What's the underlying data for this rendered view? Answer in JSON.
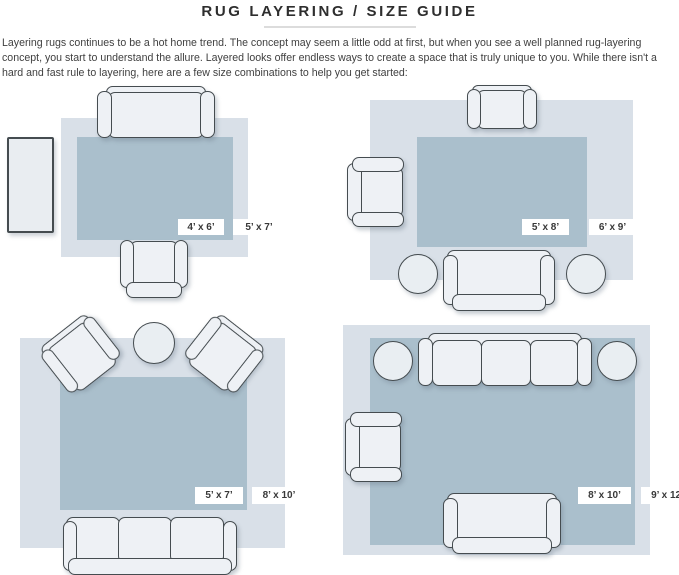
{
  "header": {
    "title": "RUG LAYERING / SIZE GUIDE",
    "intro": "Layering rugs continues to be a hot home trend. The concept may seem a little odd at first, but when you see a well planned rug-layering concept, you start to understand the allure. Layered looks offer endless ways to create a space that is truly unique to you. While there isn't a hard and fast rule to layering, here are a few size combinations to help you get started:"
  },
  "colors": {
    "outer_rug": "#d9e0e8",
    "inner_rug": "#aabfcc",
    "furniture_fill": "#eef1f5",
    "furniture_outline": "#454c50",
    "label_text": "#383838"
  },
  "layouts": [
    {
      "name": "layout-1-top-left",
      "inner_rug_size": "4’ x 6’",
      "outer_rug_size": "5’ x 7’",
      "furniture": [
        "sofa",
        "armchair",
        "console-table"
      ]
    },
    {
      "name": "layout-2-top-right",
      "inner_rug_size": "5’ x 8’",
      "outer_rug_size": "6’ x 9’",
      "furniture": [
        "armchair",
        "armchair",
        "loveseat",
        "ottoman",
        "ottoman"
      ]
    },
    {
      "name": "layout-3-bottom-left",
      "inner_rug_size": "5’ x 7’",
      "outer_rug_size": "8’ x 10’",
      "furniture": [
        "armchair",
        "armchair",
        "round-side-table",
        "sofa"
      ]
    },
    {
      "name": "layout-4-bottom-right",
      "inner_rug_size": "8’ x 10’",
      "outer_rug_size": "9’ x 12’",
      "furniture": [
        "sofa",
        "ottoman",
        "ottoman",
        "armchair",
        "loveseat"
      ]
    }
  ]
}
